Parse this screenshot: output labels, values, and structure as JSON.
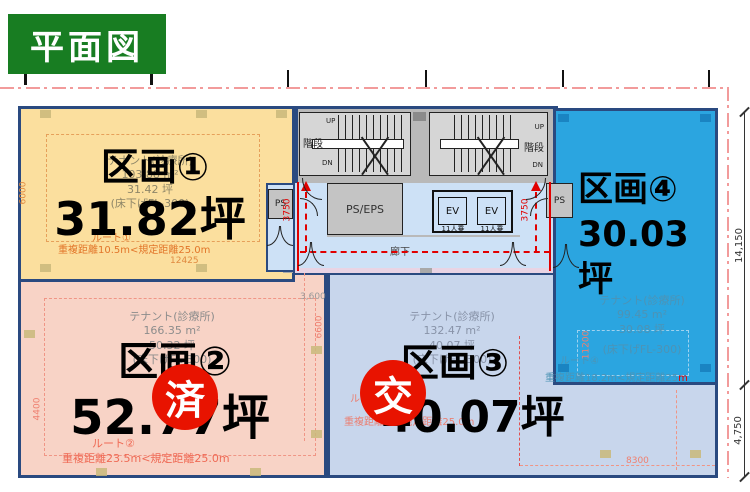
{
  "title": {
    "label": "平面図"
  },
  "sections": {
    "k1": {
      "name": "区画①",
      "tsubo": "31.82坪",
      "tenant": "テナント(診療所)",
      "area_m2": "103.88 m²",
      "area_tsubo": "31.42 坪",
      "floor_note": "(床下げFL-300)",
      "route": "ルート①",
      "route_detail": "重複距離10.5m<規定距離25.0m"
    },
    "k2": {
      "name": "区画②",
      "tsubo": "52.77坪",
      "badge": "済",
      "tenant": "テナント(診療所)",
      "area_m2": "166.35 m²",
      "area_tsubo": "50.32 坪",
      "floor_note": "(床下げFL-300)",
      "route": "ルート②",
      "route_detail": "重複距離23.5m<規定距離25.0m"
    },
    "k3": {
      "name": "区画③",
      "tsubo": "40.07坪",
      "badge": "交",
      "tenant": "テナント(診療所)",
      "area_m2": "132.47 m²",
      "area_tsubo": "40.07 坪",
      "floor_note": "(床下げFL-300)",
      "route": "ルート③",
      "route_detail": "重複距離…<規定距離25.0m"
    },
    "k4": {
      "name": "区画④",
      "tsubo_line1": "30.03",
      "tsubo_line2": "坪",
      "tenant": "テナント(診療所)",
      "area_m2": "99.45 m²",
      "area_tsubo": "30.08 坪",
      "floor_note": "(床下げFL-300)",
      "route": "ルート④",
      "route_detail": "重複距離18.2m<規定距離25",
      "route_detail_suffix": "m"
    }
  },
  "core": {
    "stairs": "階段",
    "up": "UP",
    "dn": "DN",
    "ps": "PS",
    "ps_eps": "PS/EPS",
    "ev": "EV",
    "ev_capacity": "11人乗",
    "corridor": "廊下"
  },
  "dimensions": {
    "k1_left": "6000",
    "k1_bottom": "12425",
    "k2_left": "4400",
    "k2_top": "3,600",
    "k2_vert": "6600",
    "k3_bottom": "8300",
    "k4_vert": "11200",
    "stair_left": "3750",
    "stair_right": "3750",
    "right_upper": "14,150",
    "right_lower": "4,750"
  },
  "colors": {
    "k1_fill": "#fbdf9e",
    "k2_fill": "#f8d3c6",
    "k3_fill": "#c8d6ec",
    "k4_fill": "#2ba5e0",
    "border_navy": "#2a4a80",
    "title_green": "#187d22",
    "badge_red": "#e81300",
    "boundary_pink": "#f29b9b",
    "corridor_blue": "#cfe3f7"
  }
}
